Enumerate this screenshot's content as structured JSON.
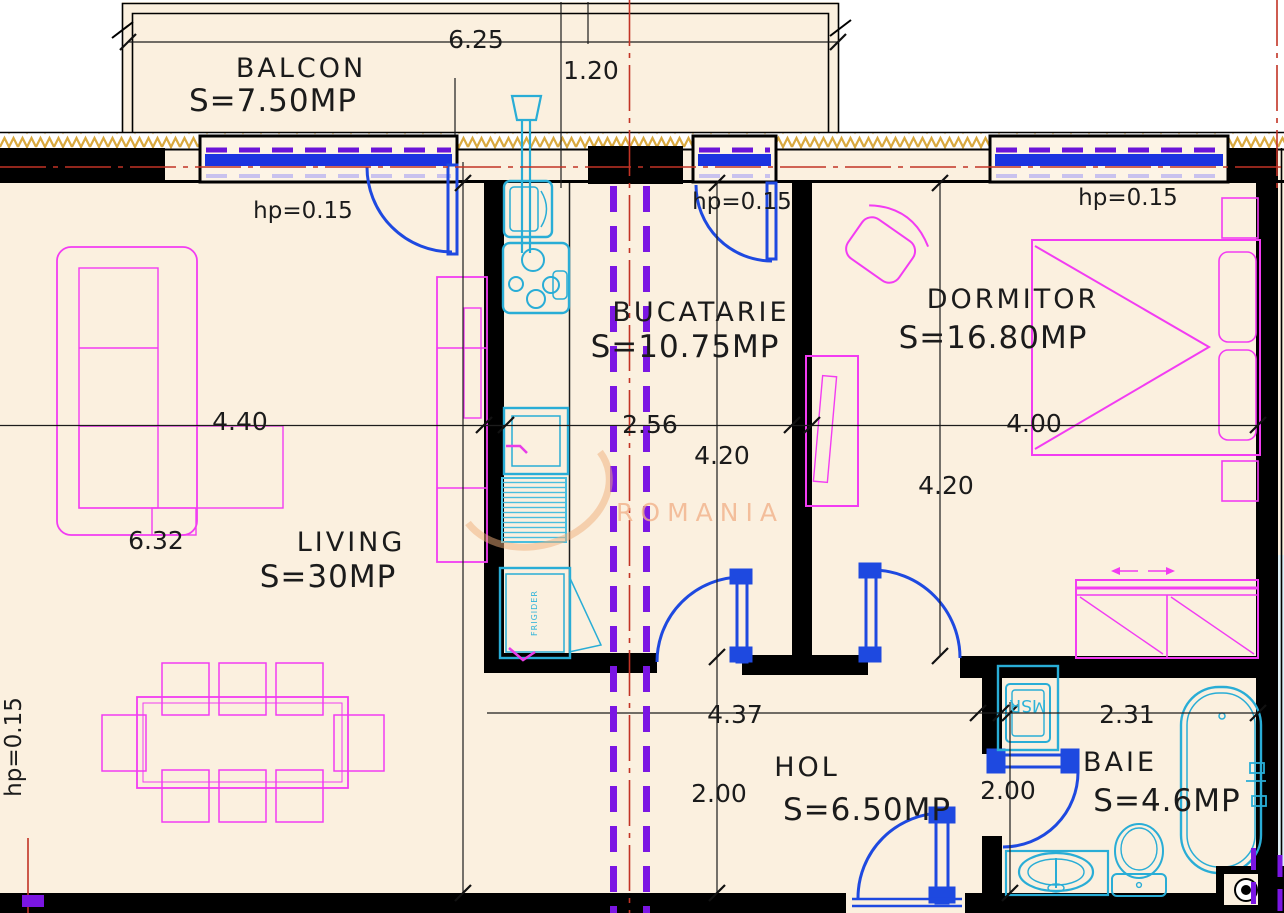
{
  "drawing": {
    "type": "apartment-floor-plan",
    "watermark": "ROMANIA"
  },
  "rooms": {
    "balcony": {
      "name": "BALCON",
      "area": "S=7.50MP",
      "dim_width": "6.25",
      "dim_depth": "1.20"
    },
    "living": {
      "name": "LIVING",
      "area": "S=30MP",
      "dim_width": "4.40",
      "dim_height": "6.32",
      "parapet": "hp=0.15",
      "parapet_left": "hp=0.15"
    },
    "kitchen": {
      "name": "BUCATARIE",
      "area": "S=10.75MP",
      "dim_width": "2.56",
      "dim_height": "4.20",
      "parapet": "hp=0.15"
    },
    "bedroom": {
      "name": "DORMITOR",
      "area": "S=16.80MP",
      "dim_width": "4.00",
      "dim_height": "4.20",
      "parapet": "hp=0.15"
    },
    "hall": {
      "name": "HOL",
      "area": "S=6.50MP",
      "dim_width": "4.37",
      "dim_height": "2.00"
    },
    "bathroom": {
      "name": "BAIE",
      "area": "S=4.6MP",
      "dim_width": "2.31",
      "dim_height": "2.00"
    }
  },
  "appliances": {
    "fridge": "FRIGIDER",
    "washing_machine": "MSR"
  },
  "colors": {
    "wall": "#000000",
    "floor": "#fbf0df",
    "window_blue": "#1b33e0",
    "door_blue": "#1e49e0",
    "fixture_cyan": "#29add6",
    "furniture_magenta": "#f23cf2",
    "section_purple": "#7b16e3",
    "centerline_red": "#c23325",
    "hatch_gold": "#d9a93f",
    "watermark_orange": "#f2b088"
  }
}
